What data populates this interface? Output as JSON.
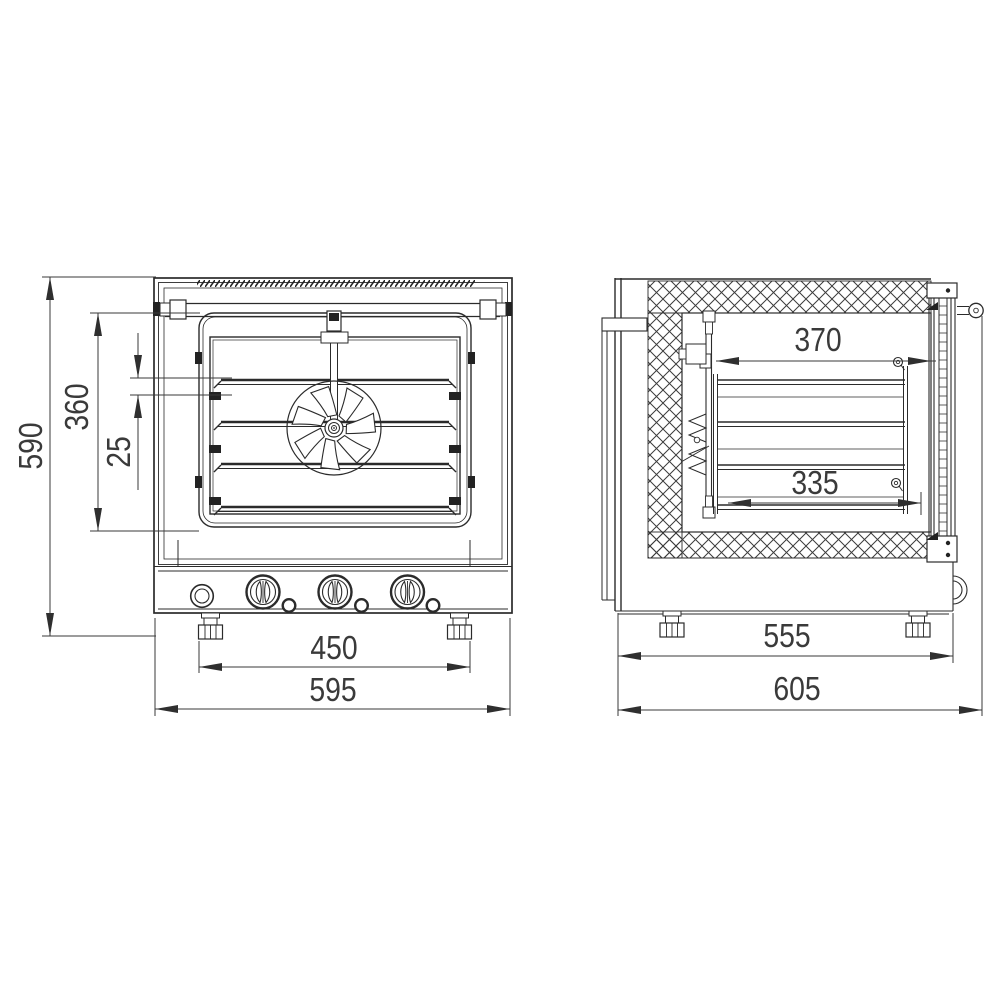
{
  "drawing": {
    "subject": "Convection oven overall dimension drawing - front and side views",
    "background": "#ffffff",
    "line_color": "#2b2b2b",
    "dimension_color": "#3a3a3a",
    "front_view": {
      "name": "front-view",
      "dims": {
        "overall_height": "590",
        "chamber_height": "360",
        "rack_pitch": "25",
        "feet_span": "450",
        "overall_width": "595"
      }
    },
    "side_view": {
      "name": "side-view",
      "dims": {
        "chamber_depth": "370",
        "tray_depth": "335",
        "body_depth": "555",
        "overall_depth": "605"
      }
    }
  }
}
